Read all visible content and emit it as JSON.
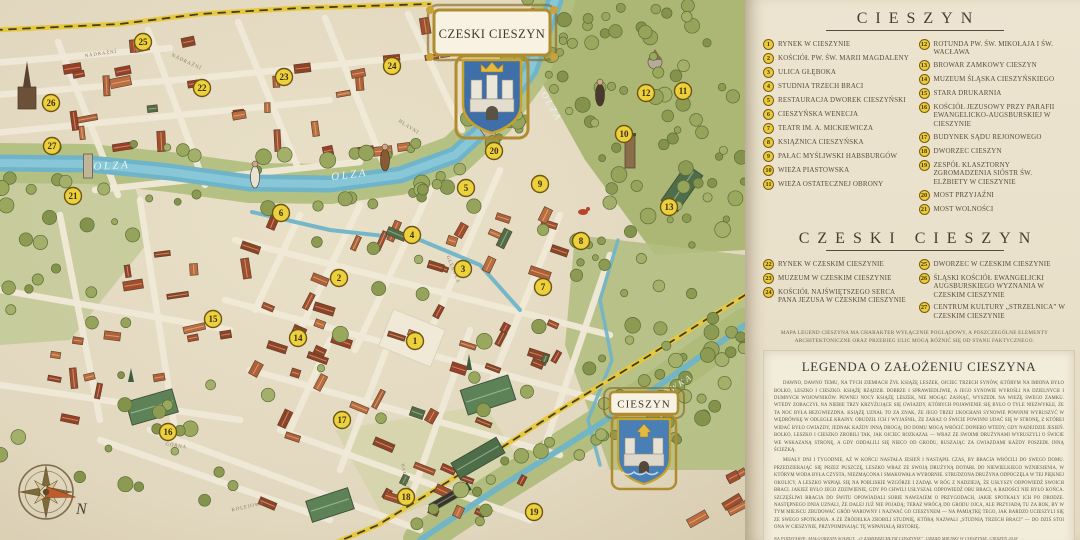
{
  "map": {
    "banners": {
      "top": {
        "title": "CZESKI CIESZYN"
      },
      "bottom": {
        "title": "CIESZYN"
      }
    },
    "compass_label": "N",
    "labels": [
      {
        "text": "OLZA",
        "x": 112,
        "y": 169,
        "rot": -3,
        "kind": "river",
        "size": 11
      },
      {
        "text": "OLZA",
        "x": 350,
        "y": 178,
        "rot": -7,
        "kind": "river",
        "size": 11
      },
      {
        "text": "OLZA",
        "x": 549,
        "y": 108,
        "rot": 60,
        "kind": "river",
        "size": 9.5
      },
      {
        "text": "BOBRÓWKA",
        "x": 666,
        "y": 396,
        "rot": -33,
        "kind": "river",
        "size": 8.5
      },
      {
        "text": "NÁDRAŽNÍ",
        "x": 101,
        "y": 55,
        "rot": -8,
        "kind": "street",
        "size": 5
      },
      {
        "text": "NÁDRAŽNÍ",
        "x": 186,
        "y": 63,
        "rot": 25,
        "kind": "street",
        "size": 5
      },
      {
        "text": "HLAVNÍ",
        "x": 408,
        "y": 128,
        "rot": 33,
        "kind": "street",
        "size": 5
      },
      {
        "text": "GŁĘBOKA",
        "x": 452,
        "y": 270,
        "rot": 68,
        "kind": "street",
        "size": 5
      },
      {
        "text": "GÓRNA",
        "x": 176,
        "y": 447,
        "rot": 9,
        "kind": "street",
        "size": 5
      },
      {
        "text": "HAJDUKA",
        "x": 404,
        "y": 477,
        "rot": 78,
        "kind": "street",
        "size": 4.5
      },
      {
        "text": "KOLEJOWA",
        "x": 248,
        "y": 508,
        "rot": -12,
        "kind": "street",
        "size": 5
      }
    ],
    "markers": [
      {
        "num": "1",
        "x": 415,
        "y": 341
      },
      {
        "num": "2",
        "x": 339,
        "y": 278
      },
      {
        "num": "3",
        "x": 463,
        "y": 269
      },
      {
        "num": "4",
        "x": 412,
        "y": 235
      },
      {
        "num": "5",
        "x": 466,
        "y": 188
      },
      {
        "num": "6",
        "x": 281,
        "y": 213
      },
      {
        "num": "7",
        "x": 543,
        "y": 287
      },
      {
        "num": "8",
        "x": 581,
        "y": 241
      },
      {
        "num": "9",
        "x": 540,
        "y": 184
      },
      {
        "num": "10",
        "x": 624,
        "y": 134
      },
      {
        "num": "11",
        "x": 683,
        "y": 91
      },
      {
        "num": "12",
        "x": 646,
        "y": 93
      },
      {
        "num": "13",
        "x": 669,
        "y": 207
      },
      {
        "num": "14",
        "x": 298,
        "y": 338
      },
      {
        "num": "15",
        "x": 213,
        "y": 319
      },
      {
        "num": "16",
        "x": 168,
        "y": 432
      },
      {
        "num": "17",
        "x": 342,
        "y": 420
      },
      {
        "num": "18",
        "x": 406,
        "y": 497
      },
      {
        "num": "19",
        "x": 534,
        "y": 512
      },
      {
        "num": "20",
        "x": 494,
        "y": 151
      },
      {
        "num": "21",
        "x": 73,
        "y": 196
      },
      {
        "num": "22",
        "x": 202,
        "y": 88
      },
      {
        "num": "23",
        "x": 284,
        "y": 77
      },
      {
        "num": "24",
        "x": 392,
        "y": 66
      },
      {
        "num": "25",
        "x": 143,
        "y": 42
      },
      {
        "num": "26",
        "x": 51,
        "y": 103
      },
      {
        "num": "27",
        "x": 52,
        "y": 146
      }
    ]
  },
  "panel": {
    "sections": [
      {
        "title": "CIESZYN",
        "columns": [
          [
            {
              "num": "1",
              "text": "RYNEK W CIESZYNIE"
            },
            {
              "num": "2",
              "text": "KOŚCIÓŁ PW. ŚW. MARII MAGDALENY"
            },
            {
              "num": "3",
              "text": "ULICA GŁĘBOKA"
            },
            {
              "num": "4",
              "text": "STUDNIA TRZECH BRACI"
            },
            {
              "num": "5",
              "text": "RESTAURACJA DWOREK CIESZYŃSKI"
            },
            {
              "num": "6",
              "text": "CIESZYŃSKA WENECJA"
            },
            {
              "num": "7",
              "text": "TEATR IM. A. MICKIEWICZA"
            },
            {
              "num": "8",
              "text": "KSIĄŻNICA CIESZYŃSKA"
            },
            {
              "num": "9",
              "text": "PAŁAC MYŚLIWSKI HABSBURGÓW"
            },
            {
              "num": "10",
              "text": "WIEŻA PIASTOWSKA"
            },
            {
              "num": "11",
              "text": "WIEŻA OSTATECZNEJ OBRONY"
            }
          ],
          [
            {
              "num": "12",
              "text": "ROTUNDA PW. ŚW. MIKOŁAJA I ŚW. WACŁAWA"
            },
            {
              "num": "13",
              "text": "BROWAR ZAMKOWY CIESZYN"
            },
            {
              "num": "14",
              "text": "MUZEUM ŚLĄSKA CIESZYŃSKIEGO"
            },
            {
              "num": "15",
              "text": "STARA DRUKARNIA"
            },
            {
              "num": "16",
              "text": "KOŚCIÓŁ JEZUSOWY PRZY PARAFII EWANGELICKO-AUGSBURSKIEJ W CIESZYNIE"
            },
            {
              "num": "17",
              "text": "BUDYNEK SĄDU REJONOWEGO"
            },
            {
              "num": "18",
              "text": "DWORZEC CIESZYN"
            },
            {
              "num": "19",
              "text": "ZESPÓŁ KLASZTORNY ZGROMADZENIA SIÓSTR ŚW. ELŻBIETY W CIESZYNIE"
            },
            {
              "num": "20",
              "text": "MOST PRZYJAŹNI"
            },
            {
              "num": "21",
              "text": "MOST WOLNOŚCI"
            }
          ]
        ]
      },
      {
        "title": "CZESKI CIESZYN",
        "columns": [
          [
            {
              "num": "22",
              "text": "RYNEK W CZESKIM CIESZYNIE"
            },
            {
              "num": "23",
              "text": "MUZEUM W CZESKIM CIESZYNIE"
            },
            {
              "num": "24",
              "text": "KOŚCIÓŁ NAJŚWIĘTSZEGO SERCA PANA JEZUSA W CZESKIM CIESZYNIE"
            }
          ],
          [
            {
              "num": "25",
              "text": "DWORZEC W CZESKIM CIESZYNIE"
            },
            {
              "num": "26",
              "text": "ŚLĄSKI KOŚCIÓŁ EWANGELICKI AUGSBURSKIEGO WYZNANIA W CZESKIM CIESZYNIE"
            },
            {
              "num": "27",
              "text": "CENTRUM KULTURY „STRZELNICA” W CZESKIM CIESZYNIE"
            }
          ]
        ]
      }
    ],
    "disclaimer": "MAPA LEGEND CIESZYNA MA CHARAKTER WYŁĄCZNIE POGLĄDOWY, A POSZCZEGÓLNE ELEMENTY ARCHITEKTONICZNE ORAZ PRZEBIEG ULIC MOGĄ RÓŻNIĆ SIĘ OD STANU FAKTYCZNEGO.",
    "story": {
      "title": "LEGENDA O ZAŁOŻENIU CIESZYNA",
      "paragraphs": [
        "DAWNO, DAWNO TEMU, NA TYCH ZIEMIACH ŻYŁ KSIĄŻĘ LESZEK, OJCIEC TRZECH SYNÓW, KTÓRYM NA IMIONA BYŁO BOLKO, LESZKO I CIESZKO. KSIĄŻĘ RZĄDZIŁ DOBRZE I SPRAWIEDLIWIE, A JEGO SYNOWIE WYROŚLI NA DZIELNYCH I DUMNYCH WOJOWNIKÓW. PEWNEJ NOCY KSIĄŻĘ LESZEK, NIE MOGĄC ZASNĄĆ, WYSZEDŁ NA WIEŻĘ SWEGO ZAMKU. WTEDY ZOBACZYŁ NA NIEBIE TRZY KRZYŻUJĄCE SIĘ GWIAZDY, KTÓRYCH POJAWIENIE SIĘ BYŁO O TYLE NIEZWYKŁE, ŻE TA NOC BYŁA BEZGWIEZDNA. KSIĄŻĘ UZNAŁ TO ZA ZNAK, ŻE JEGO TRZEJ UKOCHANI SYNOWIE POWINNI WYRUSZYĆ W WĘDRÓWKĘ W ODLEGŁE KRAINY. OBUDZIŁ ICH I WYJAŚNIŁ, ŻE ZARAZ O ŚWICIE POWINNI UDAĆ SIĘ W STRONĘ, Z KTÓREJ WIDAĆ BYŁO GWIAZDY, JEDNAK KAŻDY INNĄ DROGĄ; DO DOMU MOGĄ WRÓCIĆ DOPIERO WTEDY, GDY NADEJDZIE JESIEŃ. BOLKO, LESZKO I CIESZKO ZROBILI TAK, JAK OJCIEC ROZKAZAŁ — WRAZ ZE SWOIMI DRUŻYNAMI WYRUSZYLI O ŚWICIE WE WSKAZANĄ STRONĘ, A GDY ODDALILI SIĘ NIECO OD GRODU, RUSZAJĄC ZA GWIAZDAMI KAŻDY POSZEDŁ INNĄ ŚCIEŻKĄ.",
        "MIJAŁY DNI I TYGODNIE, AŻ W KOŃCU NASTAŁA JESIEŃ I NASTĄPIŁ CZAS, BY BRACIA WRÓCILI DO SWEGO DOMU. PRZEDZIERAJĄC SIĘ PRZEZ PUSZCZĘ, LESZKO WRAZ ZE SWOJĄ DRUŻYNĄ DOTARŁ DO NIEWIELKIEGO WZNIESIENIA, W KTÓRYM WODA BYŁA CZYSTA, NIEZMĄCONA I SMAKOWAŁA WYBORNIE. STRUDZONA DRUŻYNA ODPOCZĘŁA W TEJ PIĘKNEJ OKOLICY, A LESZKO WSPIĄŁ SIĘ NA POBLISKIE WZGÓRZE I ZADĄŁ W RÓG Z NADZIEJĄ, ŻE USŁYSZY ODPOWIEDŹ SWOICH BRACI. JAKIEŻ BYŁO JEGO ZDZIWIENIE, GDY PO CHWILI USŁYSZAŁ ODPOWIEDŹ OBU BRACI, A RADOŚCI NIE BYŁO KOŃCA. SZCZĘŚLIWI BRACIA DO ŚWITU OPOWIADALI SOBIE NAWZAJEM O PRZYGODACH, JAKIE SPOTKAŁY ICH PO DRODZE. NASTĘPNEGO DNIA UZNALI, ŻE DALEJ JUŻ NIE POJADĄ; TERAZ WRÓCĄ DO GRODU OJCA, ALE PRZYJADĄ TU ZA ROK, BY W TYM MIEJSCU ZBUDOWAĆ GRÓD WAROWNY I NAZWAĆ GO CIESZYNEM — NA PAMIĄTKĘ TEGO, JAK BARDZO UCIESZYLI SIĘ ZE SWEGO SPOTKANIA. A ZE ŹRÓDEŁKA ZROBILI STUDNIĘ, KTÓRĄ NAZWALI „STUDNIĄ TRZECH BRACI” — DO DZIŚ STOI ONA W CIESZYNIE, PRZYPOMINAJĄC TĘ WSPANIAŁĄ HISTORIĘ."
      ],
      "source": "NA PODSTAWIE: MAŁGORZATA SOŁBUT, „O ZAMIERZCHŁYM CIESZYNIE”, URZĄD MIEJSKI W CIESZYNIE, CIESZYN 2018"
    }
  },
  "colors": {
    "marker_fill": "#ecd13d",
    "marker_stroke": "#6d5513",
    "river": "#6fb4c8",
    "gold": "#b08c2e"
  }
}
